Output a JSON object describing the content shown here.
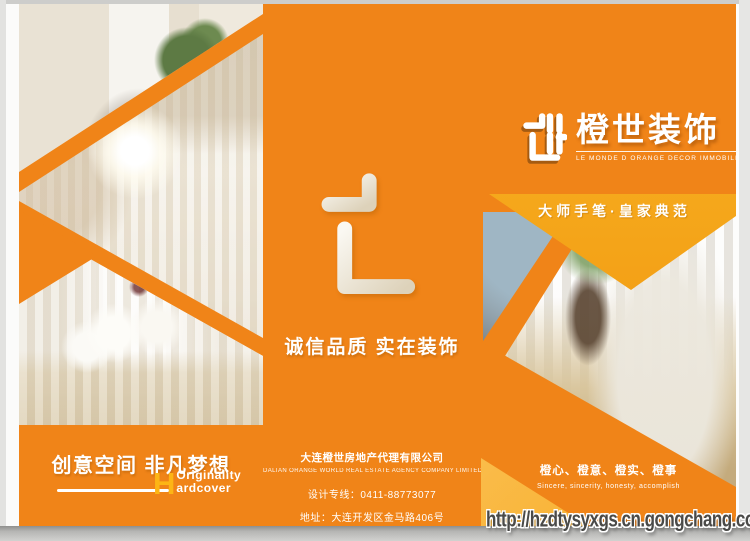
{
  "brand": {
    "name": "橙世装饰",
    "subtitle": "LE MONDE D ORANGE DECOR IMMOBILIER"
  },
  "panels": {
    "left": {
      "headline": "创意空间 非凡梦想",
      "english_initial": "H",
      "english_line1": "Originality",
      "english_line2": "ardcover"
    },
    "center": {
      "slogan": "诚信品质 实在装饰",
      "company_cn": "大连橙世房地产代理有限公司",
      "company_en": "DALIAN ORANGE WORLD REAL ESTATE AGENCY COMPANY LIMITED",
      "phone": "设计专线：0411-88773077",
      "address": "地址：大连开发区金马路406号"
    },
    "right": {
      "tagline": "大师手笔·皇家典范",
      "values_cn": "橙心、橙意、橙实、橙事",
      "values_en": "Sincere, sincerity, honesty, accomplish"
    }
  },
  "watermark": {
    "url": "http://hzdtysyxgs.cn.gongchang.com"
  },
  "colors": {
    "orange": "#F08418",
    "yellow": "#F8AC1E",
    "light_yellow": "#FBC55F"
  }
}
